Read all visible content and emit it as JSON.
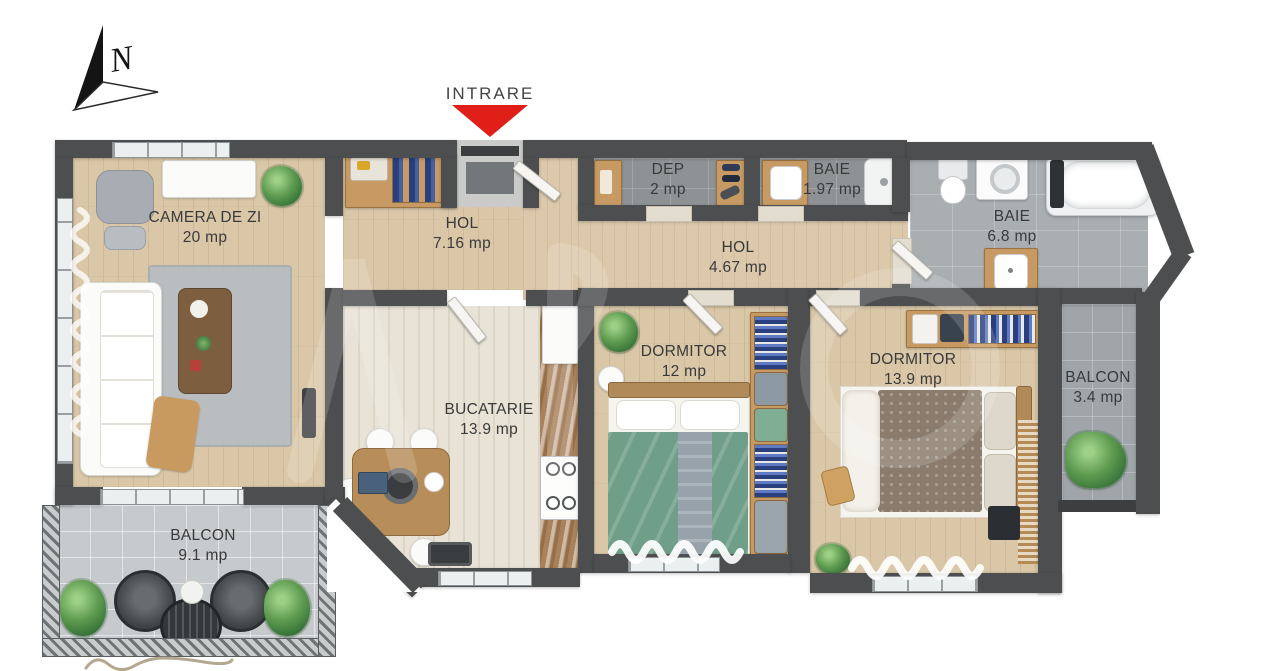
{
  "plan": {
    "entrance_label": "INTRARE",
    "compass_letter": "N",
    "unit_suffix": "mp"
  },
  "colors": {
    "wall": "#4c4e4f",
    "entrance_arrow": "#e02018",
    "wood_floor": "#d9c7a8",
    "kitchen_floor": "#e9e3d7",
    "bath_tile": "#8e9295",
    "balcony_tile": "#c6cacc",
    "bed_green": "#6f9f88",
    "label_text": "#3a3a3a"
  },
  "rooms": [
    {
      "id": "camera-de-zi",
      "name": "CAMERA DE ZI",
      "area": "20 mp"
    },
    {
      "id": "hol-1",
      "name": "HOL",
      "area": "7.16 mp"
    },
    {
      "id": "dep",
      "name": "DEP",
      "area": "2 mp"
    },
    {
      "id": "baie-1",
      "name": "BAIE",
      "area": "1.97 mp"
    },
    {
      "id": "hol-2",
      "name": "HOL",
      "area": "4.67 mp"
    },
    {
      "id": "baie-2",
      "name": "BAIE",
      "area": "6.8 mp"
    },
    {
      "id": "dormitor-1",
      "name": "DORMITOR",
      "area": "12 mp"
    },
    {
      "id": "bucatarie",
      "name": "BUCATARIE",
      "area": "13.9 mp"
    },
    {
      "id": "dormitor-2",
      "name": "DORMITOR",
      "area": "13.9 mp"
    },
    {
      "id": "balcon-1",
      "name": "BALCON",
      "area": "3.4 mp"
    },
    {
      "id": "balcon-2",
      "name": "BALCON",
      "area": "9.1 mp"
    }
  ]
}
